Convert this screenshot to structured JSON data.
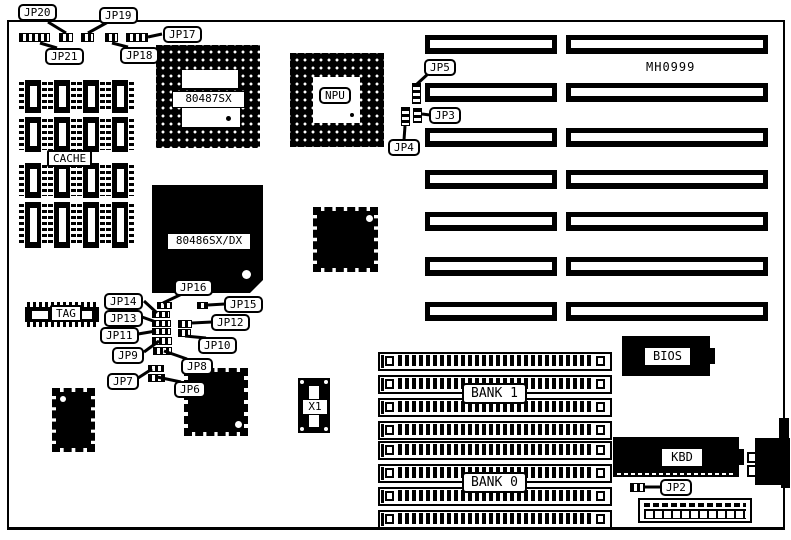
{
  "board": {
    "model_text": "MH0999",
    "labels": {
      "cache": "CACHE",
      "tag": "TAG",
      "cpu": "80486SX/DX",
      "copro_socket": "80487SX",
      "npu": "NPU",
      "crystal": "X1",
      "bank1": "BANK 1",
      "bank0": "BANK 0",
      "bios": "BIOS",
      "kbd": "KBD"
    },
    "jumpers": {
      "jp2": "JP2",
      "jp3": "JP3",
      "jp4": "JP4",
      "jp5": "JP5",
      "jp6": "JP6",
      "jp7": "JP7",
      "jp8": "JP8",
      "jp9": "JP9",
      "jp10": "JP10",
      "jp11": "JP11",
      "jp12": "JP12",
      "jp13": "JP13",
      "jp14": "JP14",
      "jp15": "JP15",
      "jp16": "JP16",
      "jp17": "JP17",
      "jp18": "JP18",
      "jp19": "JP19",
      "jp20": "JP20",
      "jp21": "JP21"
    },
    "colors": {
      "ink": "#000000",
      "background": "#ffffff"
    }
  }
}
